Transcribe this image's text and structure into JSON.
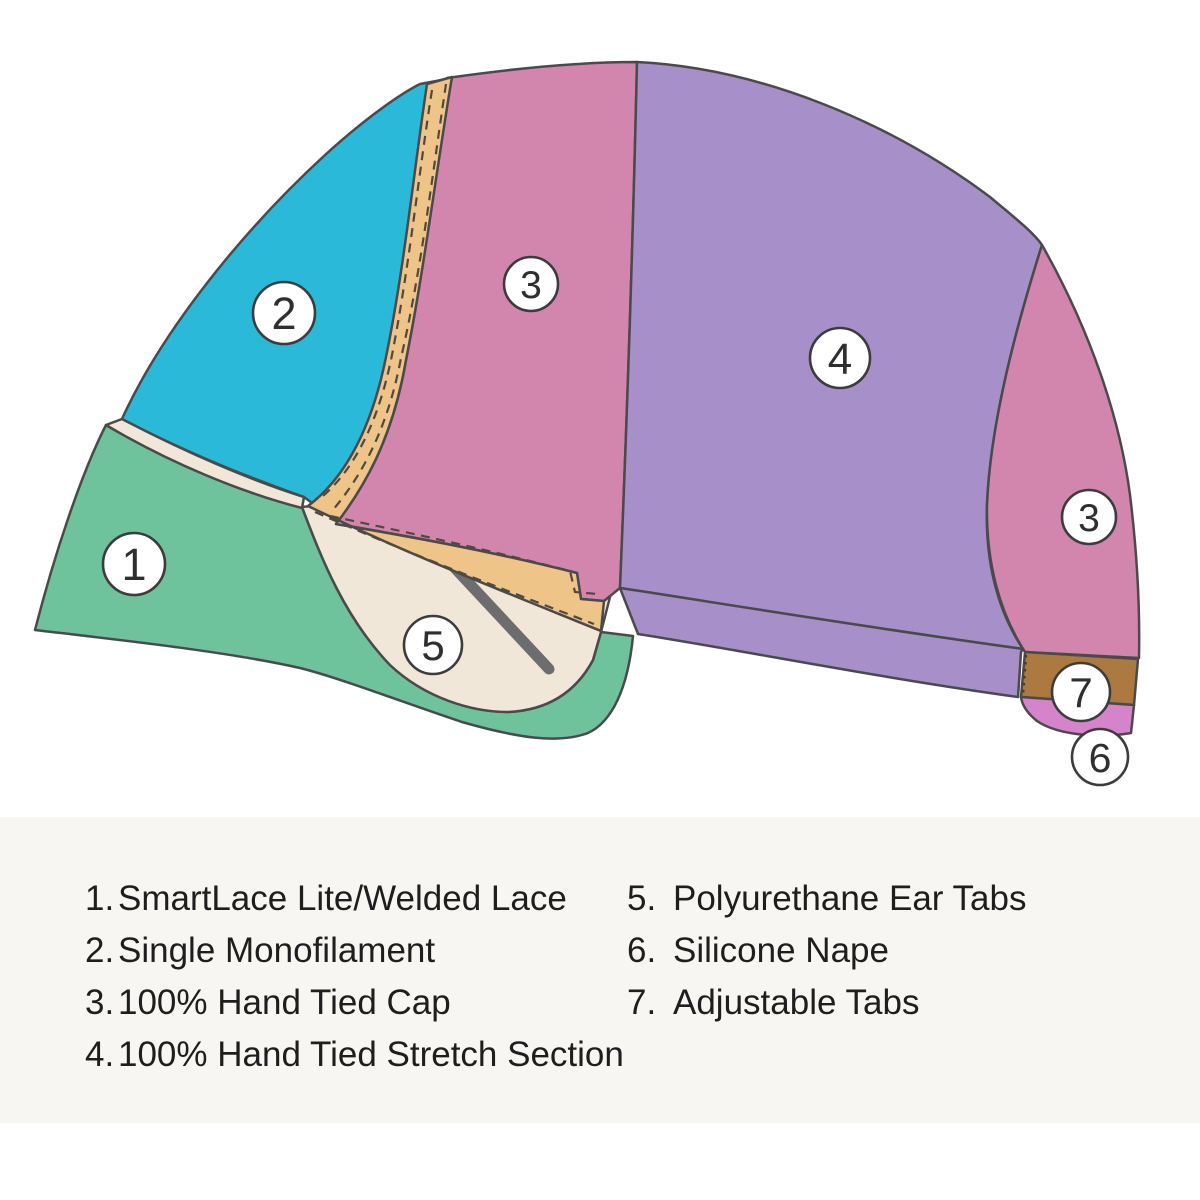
{
  "figure": {
    "colors": {
      "outline": "#4A4A4A",
      "green": "#6FC39C",
      "teal": "#2BB9D9",
      "pink": "#D286AE",
      "purple": "#A78FC9",
      "cream": "#F1E7D8",
      "orchid": "#D583CB",
      "brown": "#AC7A41",
      "tan_band": "#EFC489",
      "stitch": "#4F4A40",
      "tab_dotted": "#4E3B27",
      "strap": "#6E6D6D",
      "marker_fill": "#FFFFFF",
      "marker_stroke": "#3C3C3C",
      "marker_text": "#2F2F2F"
    },
    "markers": [
      {
        "label": "1",
        "cx": 134,
        "cy": 564,
        "r": 31
      },
      {
        "label": "2",
        "cx": 284,
        "cy": 313,
        "r": 31
      },
      {
        "label": "3",
        "cx": 531,
        "cy": 284,
        "r": 27
      },
      {
        "label": "4",
        "cx": 840,
        "cy": 358,
        "r": 30
      },
      {
        "label": "3",
        "cx": 1089,
        "cy": 517,
        "r": 27
      },
      {
        "label": "5",
        "cx": 433,
        "cy": 645,
        "r": 29
      },
      {
        "label": "7",
        "cx": 1081,
        "cy": 692,
        "r": 29
      },
      {
        "label": "6",
        "cx": 1100,
        "cy": 757,
        "r": 28
      }
    ]
  },
  "legend": {
    "background": "#F8F6F2",
    "text_color": "#1E1E1E",
    "left": [
      {
        "num": "1.",
        "label": "SmartLace Lite/Welded Lace"
      },
      {
        "num": "2.",
        "label": "Single Monofilament"
      },
      {
        "num": "3.",
        "label": "100% Hand Tied Cap"
      },
      {
        "num": "4.",
        "label": "100% Hand Tied Stretch Section"
      }
    ],
    "right": [
      {
        "num": "5.",
        "label": "Polyurethane Ear Tabs"
      },
      {
        "num": "6.",
        "label": "Silicone Nape"
      },
      {
        "num": "7.",
        "label": "Adjustable Tabs"
      }
    ]
  }
}
